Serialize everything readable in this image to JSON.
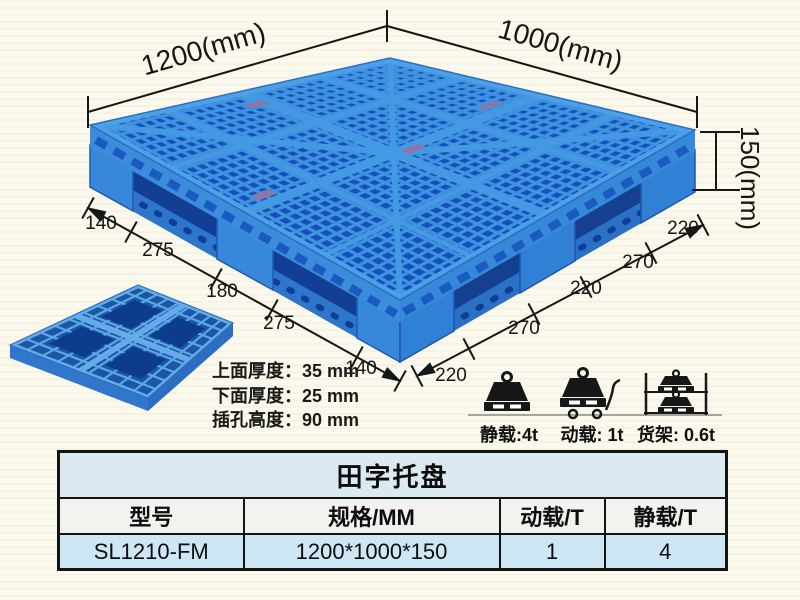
{
  "colors": {
    "pallet_blue": "#2e7ecf",
    "pallet_dark_blue": "#1550bd",
    "pallet_light_rib": "#3e92de",
    "dimension_ink": "#161616",
    "table_title_bg": "#dbe9f1",
    "table_header_bg": "#f2f2ee",
    "table_row_bg": "#cde7f5",
    "background": "#fbf9ed"
  },
  "diagram": {
    "width_label": "1200(mm)",
    "depth_label": "1000(mm)",
    "height_label": "150(mm)",
    "left_edge_segments": [
      "140",
      "275",
      "180",
      "275",
      "140"
    ],
    "right_edge_segments": [
      "220",
      "270",
      "220",
      "270",
      "220"
    ],
    "spec_lines": [
      "上面厚度：35 mm",
      "下面厚度：25 mm",
      "插孔高度：90 mm"
    ],
    "load_ratings": [
      {
        "icon": "static-load-weight-icon",
        "label": "静载:4t"
      },
      {
        "icon": "dynamic-load-trolley-icon",
        "label": "动载: 1t"
      },
      {
        "icon": "rack-load-shelf-icon",
        "label": "货架: 0.6t"
      }
    ]
  },
  "table": {
    "title": "田字托盘",
    "headers": [
      "型号",
      "规格/MM",
      "动载/T",
      "静载/T"
    ],
    "rows": [
      [
        "SL1210-FM",
        "1200*1000*150",
        "1",
        "4"
      ]
    ]
  }
}
